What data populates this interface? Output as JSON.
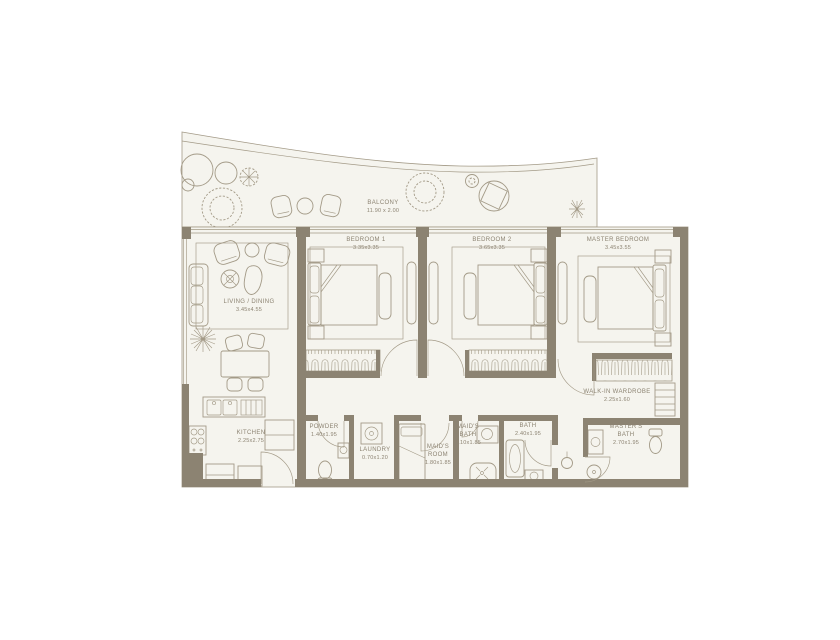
{
  "colors": {
    "wall": "#8c8372",
    "line": "#a39a87",
    "room_fill": "#f5f4ee",
    "text": "#8c8372"
  },
  "rooms": {
    "balcony": {
      "name": "BALCONY",
      "dims": "11.90 x 2.00"
    },
    "living_dining": {
      "name": "LIVING / DINING",
      "dims": "3.45x4.55"
    },
    "bedroom_1": {
      "name": "BEDROOM 1",
      "dims": "3.35x3.35"
    },
    "bedroom_2": {
      "name": "BEDROOM 2",
      "dims": "3.65x3.35"
    },
    "master_bedroom": {
      "name": "MASTER BEDROOM",
      "dims": "3.45x3.55"
    },
    "kitchen": {
      "name": "KITCHEN",
      "dims": "2.25x2.75"
    },
    "powder": {
      "name": "POWDER",
      "dims": "1.40x1.95"
    },
    "laundry": {
      "name": "LAUNDRY",
      "dims": "0.70x1.20"
    },
    "maids_room": {
      "name": "MAID'S ROOM",
      "dims": "1.80x1.85"
    },
    "maids_bath": {
      "name": "MAID'S BATH",
      "dims": "1.10x1.85"
    },
    "bath": {
      "name": "BATH",
      "dims": "2.40x1.95"
    },
    "walk_in_wardrobe": {
      "name": "WALK-IN WARDROBE",
      "dims": "2.25x1.60"
    },
    "masters_bath": {
      "name": "MASTER'S BATH",
      "dims": "2.70x1.95"
    }
  }
}
